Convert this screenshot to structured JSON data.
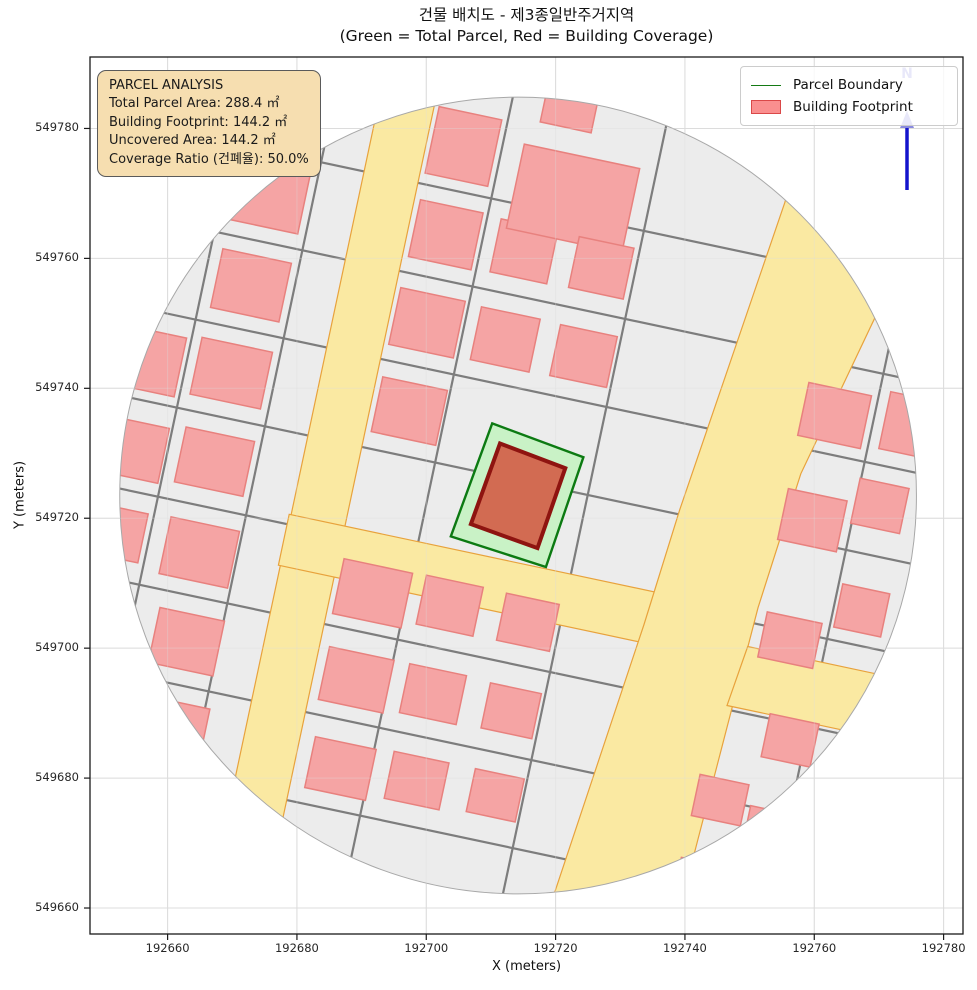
{
  "figure": {
    "width": 977,
    "height": 990,
    "background": "#ffffff"
  },
  "title": {
    "line1": "건물 배치도 - 제3종일반주거지역",
    "line2": "(Green = Total Parcel, Red = Building Coverage)"
  },
  "axes": {
    "xlabel": "X (meters)",
    "ylabel": "Y (meters)",
    "x_ticks": [
      192660,
      192680,
      192700,
      192720,
      192740,
      192760,
      192780
    ],
    "y_ticks": [
      549660,
      549680,
      549700,
      549720,
      549740,
      549760,
      549780
    ],
    "x_range": [
      192648,
      192783
    ],
    "y_range": [
      549656,
      549791
    ],
    "grid": true
  },
  "legend": {
    "items": [
      {
        "label": "Parcel Boundary",
        "swatch": "line",
        "color": "#147a14"
      },
      {
        "label": "Building Footprint",
        "swatch": "patch",
        "fill": "#fa8f8f",
        "edge": "#da4848"
      }
    ]
  },
  "info_box": {
    "bg": "#f6deb0",
    "lines": [
      "PARCEL ANALYSIS",
      "Total Parcel Area: 288.4 ㎡",
      "Building Footprint: 144.2 ㎡",
      "Uncovered Area: 144.2 ㎡",
      "Coverage Ratio (건폐율): 50.0%"
    ]
  },
  "north_arrow": {
    "label": "N",
    "shaft_color": "#1414cc",
    "label_color": "#8a8ade"
  },
  "chart_data": {
    "type": "map",
    "title": "건물 배치도 - 제3종일반주거지역",
    "subtitle": "(Green = Total Parcel, Red = Building Coverage)",
    "zoning": "제3종일반주거지역",
    "parcel_area_sqm": 288.4,
    "building_footprint_sqm": 144.2,
    "uncovered_area_sqm": 144.2,
    "coverage_ratio_pct": 50.0,
    "map_center_m": [
      192714.2,
      549723.5
    ],
    "map_radius_m": 61.6,
    "parcel_boundary_m": [
      [
        192710.2,
        549734.6
      ],
      [
        192724.3,
        549729.4
      ],
      [
        192718.5,
        549712.5
      ],
      [
        192703.8,
        549717.2
      ]
    ],
    "building_footprint_m": [
      [
        192711.4,
        549731.5
      ],
      [
        192721.5,
        549727.7
      ],
      [
        192717.2,
        549715.4
      ],
      [
        192706.9,
        549719.1
      ]
    ],
    "styles": {
      "base": "#ececec",
      "street": "#7d7d7d",
      "road_fill": "#fae9a2",
      "road_edge": "#e8a23c",
      "building_fill": "#f5a4a4",
      "building_edge": "#e8817e",
      "parcel_fill": "#c9f2c6",
      "parcel_edge": "#0c7a12",
      "footprint_fill": "#d26b52",
      "footprint_edge": "#8e1410",
      "grid": "#dcdcdc",
      "circle_edge": "#a8a8a8"
    },
    "fabric": {
      "rotation_deg": 12,
      "streets": {
        "vertical_u": [
          -352,
          -262,
          -88,
          68,
          332
        ],
        "horizontal_v": [
          -285,
          -195,
          -105,
          -15,
          76,
          166,
          256,
          346
        ],
        "extent": 420
      },
      "roads": [
        [
          [
            -218,
            -410
          ],
          [
            -163,
            -410
          ],
          [
            -163,
            410
          ],
          [
            -218,
            410
          ]
        ],
        [
          [
            -220,
            66
          ],
          [
            175,
            66
          ],
          [
            175,
            118
          ],
          [
            -220,
            118
          ]
        ],
        [
          [
            205,
            -410
          ],
          [
            335,
            -410
          ],
          [
            322,
            -290
          ],
          [
            272,
            -80
          ],
          [
            258,
            60
          ],
          [
            246,
            331
          ],
          [
            240,
            410
          ],
          [
            115,
            410
          ],
          [
            150,
            100
          ],
          [
            161,
            -19
          ],
          [
            200,
            -342
          ]
        ],
        [
          [
            256,
            100
          ],
          [
            412,
            100
          ],
          [
            412,
            162
          ],
          [
            248,
            162
          ]
        ]
      ],
      "buildings": [
        [
          -392,
          -55,
          70,
          60
        ],
        [
          -388,
          35,
          66,
          56
        ],
        [
          -386,
          120,
          56,
          50
        ],
        [
          -306,
          -325,
          70,
          72
        ],
        [
          -306,
          -240,
          72,
          60
        ],
        [
          -305,
          -150,
          70,
          60
        ],
        [
          -306,
          -60,
          72,
          58
        ],
        [
          -304,
          30,
          70,
          56
        ],
        [
          -300,
          122,
          70,
          58
        ],
        [
          -294,
          212,
          66,
          56
        ],
        [
          -288,
          298,
          62,
          50
        ],
        [
          -126,
          -330,
          64,
          68
        ],
        [
          -125,
          -240,
          64,
          58
        ],
        [
          -125,
          -150,
          66,
          58
        ],
        [
          -124,
          -60,
          66,
          56
        ],
        [
          -122,
          126,
          70,
          56
        ],
        [
          -120,
          214,
          66,
          54
        ],
        [
          -117,
          304,
          62,
          52
        ],
        [
          -45,
          -240,
          58,
          54
        ],
        [
          -45,
          -150,
          60,
          54
        ],
        [
          -44,
          122,
          58,
          50
        ],
        [
          -42,
          212,
          58,
          50
        ],
        [
          -40,
          300,
          56,
          48
        ],
        [
          -8,
          -302,
          118,
          86
        ],
        [
          -30,
          -388,
          52,
          36
        ],
        [
          34,
          -240,
          56,
          52
        ],
        [
          35,
          -150,
          58,
          52
        ],
        [
          36,
          122,
          54,
          48
        ],
        [
          38,
          212,
          52,
          46
        ],
        [
          40,
          298,
          50,
          44
        ],
        [
          293,
          -144,
          64,
          54
        ],
        [
          368,
          -150,
          50,
          58
        ],
        [
          293,
          -37,
          60,
          52
        ],
        [
          356,
          -65,
          50,
          46
        ],
        [
          296,
          85,
          56,
          46
        ],
        [
          360,
          41,
          48,
          44
        ],
        [
          317,
          183,
          50,
          44
        ],
        [
          316,
          275,
          48,
          40
        ],
        [
          261,
          256,
          50,
          42
        ],
        [
          258,
          339,
          46,
          38
        ]
      ]
    }
  }
}
